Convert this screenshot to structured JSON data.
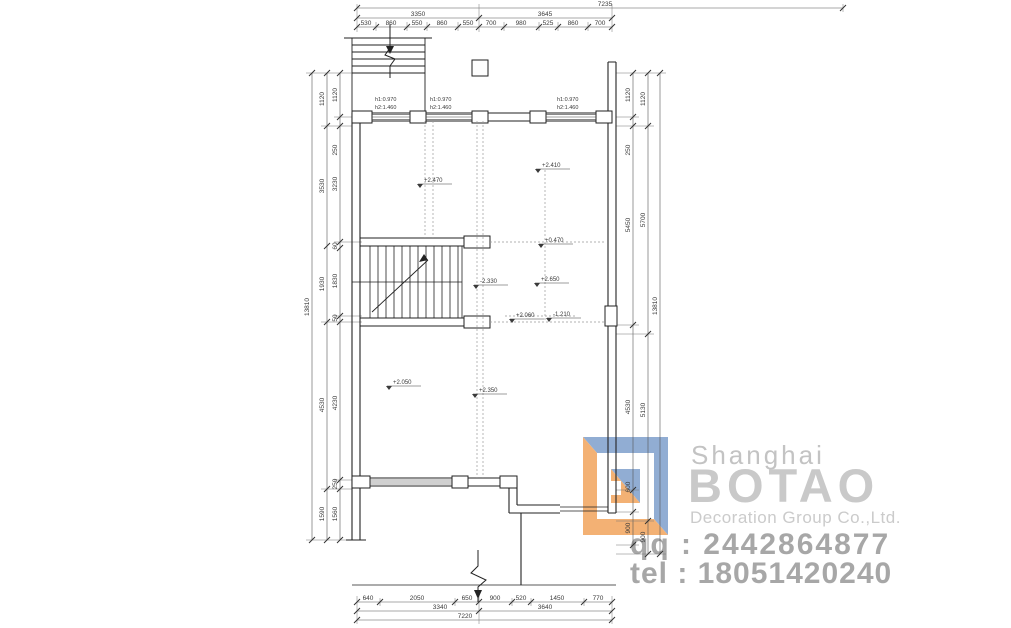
{
  "watermark": {
    "city": "Shanghai",
    "brand": "BOTAO",
    "subtitle": "Decoration Group Co.,Ltd.",
    "qq": "qq : 2442864877",
    "tel": "tel : 18051420240",
    "colors": {
      "orange": "#f2a45c",
      "blue": "#7e9fcc",
      "gray": "#c9c9c9",
      "contact_gray": "#a7a7a7"
    }
  },
  "dims": {
    "top": {
      "total": "7235",
      "groups": [
        "3350",
        "3645"
      ],
      "segments": [
        "530",
        "860",
        "550",
        "860",
        "550",
        "700",
        "980",
        "525",
        "860",
        "700"
      ]
    },
    "bottom": {
      "total": "7220",
      "groups": [
        "3340",
        "3640"
      ],
      "segments": [
        "640",
        "2050",
        "650",
        "900",
        "520",
        "1450",
        "770"
      ]
    },
    "left": {
      "total": "13810",
      "outer": [
        "1120",
        "3530",
        "1930",
        "4530",
        "1590"
      ],
      "inner": [
        "1120",
        "250",
        "3230",
        "60",
        "1830",
        "50",
        "4230",
        "250",
        "1560"
      ]
    },
    "right": {
      "total": "13810",
      "outer": [
        "1120",
        "5700",
        "5130",
        "900"
      ],
      "inner": [
        "1120",
        "250",
        "5450",
        "4530",
        "600",
        "900"
      ]
    }
  },
  "annotations": {
    "windows": [
      {
        "h1": "h1:0.970",
        "h2": "h2:1.460"
      },
      {
        "h1": "h1:0.970",
        "h2": "h2:1.460"
      },
      {
        "h1": "h1:0.970",
        "h2": "h2:1.460"
      }
    ],
    "levels": [
      "+2.470",
      "+2.410",
      "+0.470",
      "-2.330",
      "+2.650",
      "+2.060",
      "-1.210",
      "+2.050",
      "+2.350"
    ]
  }
}
